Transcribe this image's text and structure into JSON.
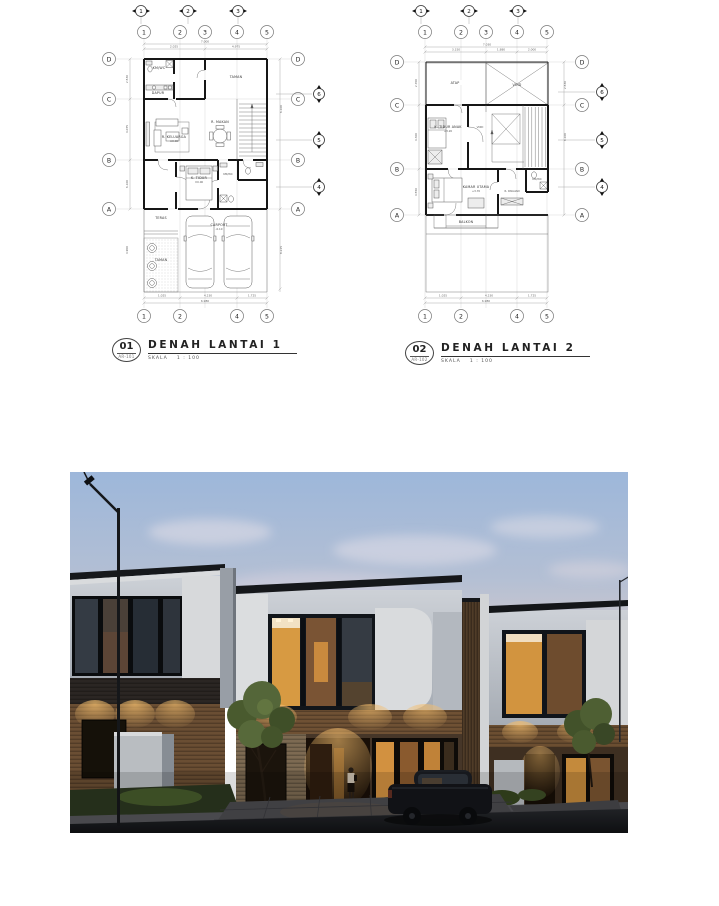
{
  "sheet": {
    "plan1": {
      "number": "01",
      "code": "AR-101",
      "title": "DENAH LANTAI 1",
      "scale_label": "SKALA",
      "scale_value": "1 : 100",
      "grid_cols": [
        "1",
        "2",
        "3",
        "4",
        "5"
      ],
      "grid_cols_bottom": [
        "1",
        "2",
        "4",
        "5"
      ],
      "grid_rows": [
        "D",
        "C",
        "B",
        "A"
      ],
      "sections_top": [
        "1",
        "2",
        "3"
      ],
      "sections_right": [
        "6",
        "5",
        "4"
      ],
      "rooms": {
        "wc_top": "KM/WC",
        "dapur": "DAPUR",
        "taman_belakang": "TAMAN",
        "keluarga": "R. KELUARGA",
        "keluarga_elev": "±0.00",
        "makan": "R. MAKAN",
        "tidur": "K. TIDUR",
        "tidur_elev": "±0.00",
        "km": "KM/WC",
        "teras": "TERAS",
        "carport": "CARPORT",
        "carport_elev": "-0.10",
        "taman_depan": "TAMAN"
      },
      "dims": {
        "top": [
          "2.025",
          "4.975"
        ],
        "top_total": "7.000",
        "bottom": [
          "1.025",
          "4.230",
          "1.725"
        ],
        "bottom_total": "6.980",
        "left": [
          "2.530",
          "4.075",
          "6.100",
          "4.900"
        ],
        "right": [
          "6.100",
          "8.225"
        ]
      }
    },
    "plan2": {
      "number": "02",
      "code": "AR-102",
      "title": "DENAH LANTAI 2",
      "scale_label": "SKALA",
      "scale_value": "1 : 100",
      "grid_cols": [
        "1",
        "2",
        "3",
        "4",
        "5"
      ],
      "grid_cols_bottom": [
        "1",
        "2",
        "4",
        "5"
      ],
      "grid_rows": [
        "D",
        "C",
        "B",
        "A"
      ],
      "sections_top": [
        "1",
        "2",
        "3"
      ],
      "sections_right": [
        "6",
        "5",
        "4"
      ],
      "rooms": {
        "atap": "ATAP",
        "void_atas": "VOID",
        "tidur_anak": "K. TIDUR ANAK",
        "tidur_anak_elev": "+3.20",
        "void_tangga": "VOID",
        "utama": "KAMAR UTAMA",
        "utama_elev": "+3.70",
        "wardrobe": "R. PAKAIAN",
        "km": "KM/WC",
        "balkon": "BALKON"
      },
      "dims": {
        "top": [
          "3.150",
          "1.880",
          "2.000"
        ],
        "top_total": "7.030",
        "bottom": [
          "1.025",
          "4.230",
          "1.725"
        ],
        "bottom_total": "6.980",
        "left": [
          "2.700",
          "4.300",
          "4.550"
        ],
        "right": [
          "2.530",
          "6.100"
        ]
      }
    }
  },
  "render": {
    "scene": "dusk exterior render of two-storey minimalist townhouses",
    "colors": {
      "sky_top": "#9db7da",
      "sky_horizon": "#ddd2d0",
      "wall_light": "#d3d6da",
      "wall_shade": "#a9afb7",
      "roof": "#16181b",
      "wood": "#6b4d31",
      "window_warm": "#d2943f",
      "window_dark": "#232930",
      "grass": "#3c4b28",
      "paving": "#4b4b4f",
      "street": "#1d1f23"
    }
  }
}
